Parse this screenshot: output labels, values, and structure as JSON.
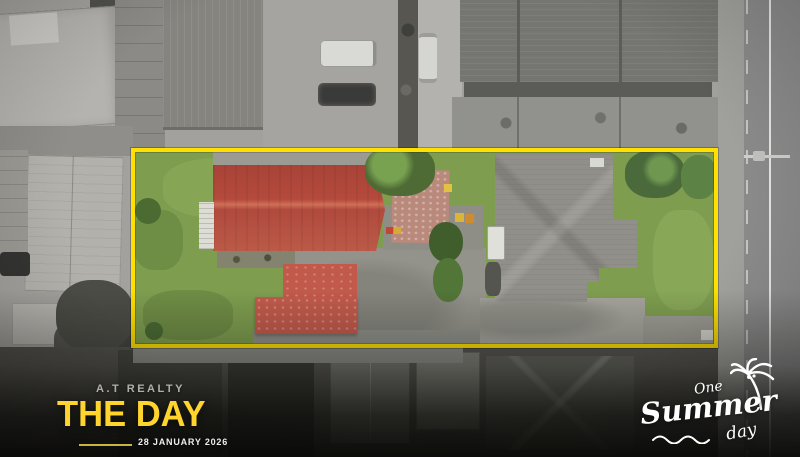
{
  "watermark": {
    "brand": "A.T REALTY",
    "title": "THE DAY",
    "date": "28 JANUARY 2026"
  },
  "logo": {
    "word_top": "One",
    "word_main": "Summer",
    "word_bottom": "day"
  },
  "icons": {
    "palm_tree": "palm-tree-icon",
    "wave": "wave-icon"
  },
  "colors": {
    "boundary_yellow": "#ffe000",
    "title_yellow": "#ffd42c",
    "red_roof": "#b54a3d",
    "shed_roof": "#c25a4b",
    "grass_green": "#7e9d4f",
    "gray_roof": "#918f89",
    "logo_white": "#ffffff"
  }
}
